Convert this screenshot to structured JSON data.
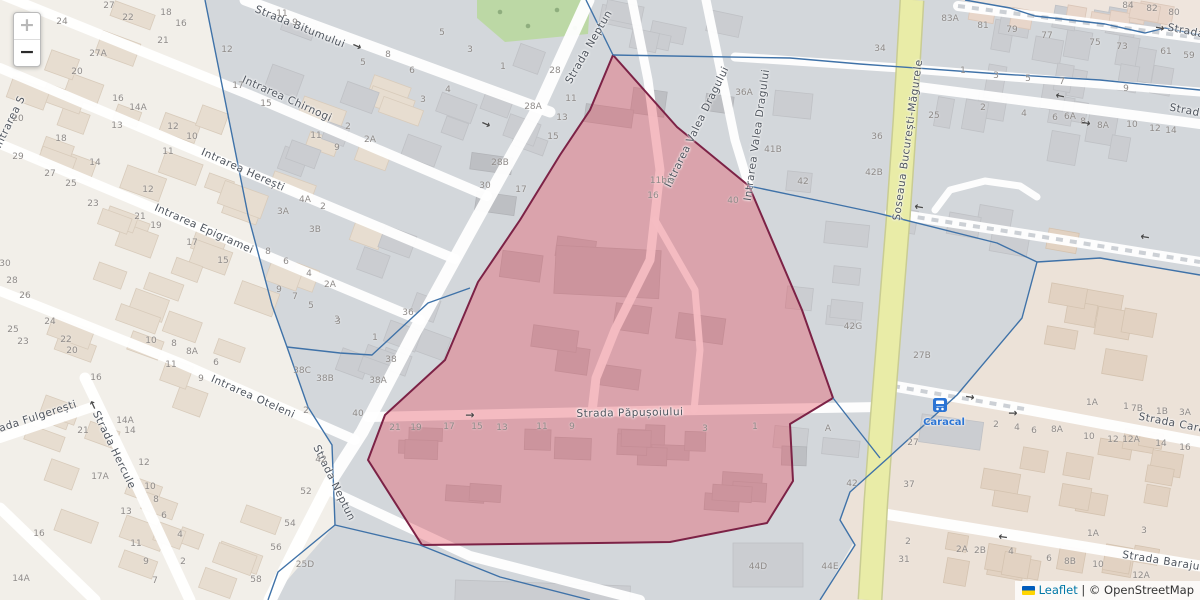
{
  "controls": {
    "zoom_in": "+",
    "zoom_out": "−"
  },
  "attribution": {
    "leaflet": "Leaflet",
    "separator": " | ",
    "osm": "© OpenStreetMap"
  },
  "colors": {
    "boundary_blue": "#3f72a8",
    "selection_fill": "#e4505f",
    "selection_stroke": "#7c2246",
    "highway_yellow": "#e9eca7",
    "park_green": "#bcd8a5",
    "transit_blue": "#2b74d4",
    "leaflet_link_blue": "#0078A8"
  },
  "pois": [
    {
      "label": "Caracal",
      "type": "bus-stop",
      "icon_x": 933,
      "icon_y": 398,
      "label_x": 944,
      "label_y": 417
    }
  ],
  "streets": [
    {
      "t": "Strada Bitumului",
      "x": 300,
      "y": 27,
      "r": 22
    },
    {
      "t": "Intrarea Chirnogi",
      "x": 287,
      "y": 99,
      "r": 24
    },
    {
      "t": "Intrarea Herești",
      "x": 243,
      "y": 170,
      "r": 24
    },
    {
      "t": "Intrarea Epigramei",
      "x": 204,
      "y": 229,
      "r": 24
    },
    {
      "t": "Intrarea Oteleni",
      "x": 253,
      "y": 397,
      "r": 24
    },
    {
      "t": "Strada Fulgerești",
      "x": 30,
      "y": 419,
      "r": -18
    },
    {
      "t": "Strada Hercule",
      "x": 114,
      "y": 450,
      "r": 64
    },
    {
      "t": "Strada Neptun",
      "x": 589,
      "y": 47,
      "r": -60
    },
    {
      "t": "Strada Neptun",
      "x": 334,
      "y": 483,
      "r": 64
    },
    {
      "t": "Intrarea Valea Dragului",
      "x": 697,
      "y": 127,
      "r": -64
    },
    {
      "t": "Intrarea Valea Dragului",
      "x": 757,
      "y": 135,
      "r": -82
    },
    {
      "t": "Șoseaua București-Măgurele",
      "x": 908,
      "y": 140,
      "r": -82
    },
    {
      "t": "Strada Păpușoiului",
      "x": 630,
      "y": 413,
      "r": -1
    },
    {
      "t": "Strada Cara",
      "x": 1172,
      "y": 423,
      "r": 11
    },
    {
      "t": "Strada Barajului",
      "x": 1168,
      "y": 562,
      "r": 9
    },
    {
      "t": "Strada",
      "x": 1186,
      "y": 31,
      "r": 11
    },
    {
      "t": "Strada",
      "x": 1188,
      "y": 111,
      "r": 11
    },
    {
      "t": "Intrarea S",
      "x": 10,
      "y": 122,
      "r": -64
    }
  ],
  "house_numbers": [
    {
      "t": "27",
      "x": 109,
      "y": 6
    },
    {
      "t": "22",
      "x": 128,
      "y": 18
    },
    {
      "t": "18",
      "x": 166,
      "y": 13
    },
    {
      "t": "16",
      "x": 181,
      "y": 24
    },
    {
      "t": "21",
      "x": 163,
      "y": 41
    },
    {
      "t": "12",
      "x": 227,
      "y": 50
    },
    {
      "t": "24",
      "x": 62,
      "y": 22
    },
    {
      "t": "27A",
      "x": 98,
      "y": 54
    },
    {
      "t": "20",
      "x": 77,
      "y": 72
    },
    {
      "t": "16",
      "x": 118,
      "y": 99
    },
    {
      "t": "14A",
      "x": 138,
      "y": 108
    },
    {
      "t": "13",
      "x": 117,
      "y": 126
    },
    {
      "t": "12",
      "x": 173,
      "y": 127
    },
    {
      "t": "10",
      "x": 192,
      "y": 137
    },
    {
      "t": "11",
      "x": 168,
      "y": 152
    },
    {
      "t": "17",
      "x": 238,
      "y": 86
    },
    {
      "t": "15",
      "x": 266,
      "y": 104
    },
    {
      "t": "20",
      "x": 18,
      "y": 119
    },
    {
      "t": "18",
      "x": 61,
      "y": 139
    },
    {
      "t": "29",
      "x": 18,
      "y": 157
    },
    {
      "t": "27",
      "x": 50,
      "y": 174
    },
    {
      "t": "25",
      "x": 71,
      "y": 184
    },
    {
      "t": "14",
      "x": 95,
      "y": 163
    },
    {
      "t": "12",
      "x": 148,
      "y": 190
    },
    {
      "t": "23",
      "x": 93,
      "y": 204
    },
    {
      "t": "21",
      "x": 140,
      "y": 217
    },
    {
      "t": "19",
      "x": 156,
      "y": 226
    },
    {
      "t": "17",
      "x": 192,
      "y": 243
    },
    {
      "t": "15",
      "x": 223,
      "y": 261
    },
    {
      "t": "30",
      "x": 5,
      "y": 264
    },
    {
      "t": "28",
      "x": 12,
      "y": 281
    },
    {
      "t": "26",
      "x": 25,
      "y": 296
    },
    {
      "t": "25",
      "x": 13,
      "y": 330
    },
    {
      "t": "23",
      "x": 23,
      "y": 342
    },
    {
      "t": "24",
      "x": 50,
      "y": 322
    },
    {
      "t": "22",
      "x": 66,
      "y": 340
    },
    {
      "t": "20",
      "x": 72,
      "y": 351
    },
    {
      "t": "16",
      "x": 96,
      "y": 378
    },
    {
      "t": "10",
      "x": 151,
      "y": 341
    },
    {
      "t": "8",
      "x": 174,
      "y": 344
    },
    {
      "t": "8A",
      "x": 192,
      "y": 352
    },
    {
      "t": "6",
      "x": 216,
      "y": 363
    },
    {
      "t": "11",
      "x": 171,
      "y": 365
    },
    {
      "t": "9",
      "x": 201,
      "y": 379
    },
    {
      "t": "21",
      "x": 83,
      "y": 431
    },
    {
      "t": "14A",
      "x": 125,
      "y": 421
    },
    {
      "t": "14",
      "x": 130,
      "y": 431
    },
    {
      "t": "12",
      "x": 144,
      "y": 463
    },
    {
      "t": "10",
      "x": 150,
      "y": 487
    },
    {
      "t": "8",
      "x": 156,
      "y": 500
    },
    {
      "t": "6",
      "x": 164,
      "y": 516
    },
    {
      "t": "4",
      "x": 180,
      "y": 535
    },
    {
      "t": "2",
      "x": 183,
      "y": 562
    },
    {
      "t": "17A",
      "x": 100,
      "y": 477
    },
    {
      "t": "13",
      "x": 126,
      "y": 512
    },
    {
      "t": "11",
      "x": 136,
      "y": 544
    },
    {
      "t": "9",
      "x": 146,
      "y": 562
    },
    {
      "t": "7",
      "x": 155,
      "y": 581
    },
    {
      "t": "16",
      "x": 39,
      "y": 534
    },
    {
      "t": "14A",
      "x": 21,
      "y": 579
    },
    {
      "t": "11",
      "x": 282,
      "y": 14
    },
    {
      "t": "9",
      "x": 295,
      "y": 23
    },
    {
      "t": "8",
      "x": 388,
      "y": 55
    },
    {
      "t": "5",
      "x": 363,
      "y": 63
    },
    {
      "t": "6",
      "x": 412,
      "y": 71
    },
    {
      "t": "5",
      "x": 442,
      "y": 33
    },
    {
      "t": "3",
      "x": 470,
      "y": 50
    },
    {
      "t": "4",
      "x": 448,
      "y": 90
    },
    {
      "t": "3",
      "x": 423,
      "y": 100
    },
    {
      "t": "1",
      "x": 503,
      "y": 67
    },
    {
      "t": "28",
      "x": 555,
      "y": 71
    },
    {
      "t": "28A",
      "x": 533,
      "y": 107
    },
    {
      "t": "28B",
      "x": 500,
      "y": 163
    },
    {
      "t": "30",
      "x": 485,
      "y": 186
    },
    {
      "t": "11",
      "x": 571,
      "y": 99
    },
    {
      "t": "13",
      "x": 562,
      "y": 118
    },
    {
      "t": "15",
      "x": 553,
      "y": 137
    },
    {
      "t": "17",
      "x": 521,
      "y": 190
    },
    {
      "t": "2A",
      "x": 370,
      "y": 140
    },
    {
      "t": "2",
      "x": 348,
      "y": 127
    },
    {
      "t": "11",
      "x": 316,
      "y": 136
    },
    {
      "t": "9",
      "x": 337,
      "y": 148
    },
    {
      "t": "4A",
      "x": 305,
      "y": 200
    },
    {
      "t": "2",
      "x": 323,
      "y": 207
    },
    {
      "t": "3A",
      "x": 283,
      "y": 212
    },
    {
      "t": "3B",
      "x": 315,
      "y": 230
    },
    {
      "t": "8",
      "x": 268,
      "y": 252
    },
    {
      "t": "6",
      "x": 286,
      "y": 262
    },
    {
      "t": "4",
      "x": 309,
      "y": 274
    },
    {
      "t": "2A",
      "x": 330,
      "y": 285
    },
    {
      "t": "9",
      "x": 279,
      "y": 290
    },
    {
      "t": "7",
      "x": 295,
      "y": 297
    },
    {
      "t": "5",
      "x": 311,
      "y": 306
    },
    {
      "t": "3",
      "x": 337,
      "y": 320
    },
    {
      "t": "36",
      "x": 408,
      "y": 313
    },
    {
      "t": "3",
      "x": 338,
      "y": 322
    },
    {
      "t": "1",
      "x": 375,
      "y": 338
    },
    {
      "t": "38",
      "x": 391,
      "y": 360
    },
    {
      "t": "38C",
      "x": 302,
      "y": 371
    },
    {
      "t": "38B",
      "x": 325,
      "y": 379
    },
    {
      "t": "38A",
      "x": 378,
      "y": 381
    },
    {
      "t": "40",
      "x": 358,
      "y": 414
    },
    {
      "t": "2",
      "x": 306,
      "y": 411
    },
    {
      "t": "11bis",
      "x": 662,
      "y": 181
    },
    {
      "t": "16",
      "x": 653,
      "y": 196
    },
    {
      "t": "40",
      "x": 733,
      "y": 201
    },
    {
      "t": "36A",
      "x": 744,
      "y": 93
    },
    {
      "t": "41B",
      "x": 773,
      "y": 150
    },
    {
      "t": "42",
      "x": 803,
      "y": 182
    },
    {
      "t": "21",
      "x": 395,
      "y": 428
    },
    {
      "t": "19",
      "x": 416,
      "y": 428
    },
    {
      "t": "17",
      "x": 449,
      "y": 427
    },
    {
      "t": "15",
      "x": 477,
      "y": 427
    },
    {
      "t": "13",
      "x": 502,
      "y": 428
    },
    {
      "t": "11",
      "x": 542,
      "y": 427
    },
    {
      "t": "9",
      "x": 572,
      "y": 427
    },
    {
      "t": "3",
      "x": 705,
      "y": 429
    },
    {
      "t": "1",
      "x": 755,
      "y": 427
    },
    {
      "t": "A",
      "x": 828,
      "y": 429
    },
    {
      "t": "42G",
      "x": 853,
      "y": 327
    },
    {
      "t": "27B",
      "x": 922,
      "y": 356
    },
    {
      "t": "42",
      "x": 852,
      "y": 484
    },
    {
      "t": "37",
      "x": 909,
      "y": 485
    },
    {
      "t": "27",
      "x": 913,
      "y": 443
    },
    {
      "t": "25D",
      "x": 305,
      "y": 565
    },
    {
      "t": "52",
      "x": 306,
      "y": 492
    },
    {
      "t": "54",
      "x": 290,
      "y": 524
    },
    {
      "t": "56",
      "x": 276,
      "y": 548
    },
    {
      "t": "58",
      "x": 256,
      "y": 580
    },
    {
      "t": "42",
      "x": 321,
      "y": 460
    },
    {
      "t": "83A",
      "x": 950,
      "y": 19
    },
    {
      "t": "81",
      "x": 983,
      "y": 26
    },
    {
      "t": "79",
      "x": 1012,
      "y": 30
    },
    {
      "t": "77",
      "x": 1047,
      "y": 36
    },
    {
      "t": "75",
      "x": 1095,
      "y": 43
    },
    {
      "t": "73",
      "x": 1122,
      "y": 47
    },
    {
      "t": "61",
      "x": 1166,
      "y": 52
    },
    {
      "t": "59",
      "x": 1189,
      "y": 56
    },
    {
      "t": "84",
      "x": 1128,
      "y": 6
    },
    {
      "t": "82",
      "x": 1152,
      "y": 9
    },
    {
      "t": "80",
      "x": 1174,
      "y": 13
    },
    {
      "t": "34",
      "x": 880,
      "y": 49
    },
    {
      "t": "1",
      "x": 963,
      "y": 71
    },
    {
      "t": "3",
      "x": 996,
      "y": 76
    },
    {
      "t": "5",
      "x": 1028,
      "y": 79
    },
    {
      "t": "7",
      "x": 1062,
      "y": 82
    },
    {
      "t": "9",
      "x": 1126,
      "y": 89
    },
    {
      "t": "25",
      "x": 934,
      "y": 116
    },
    {
      "t": "2",
      "x": 983,
      "y": 108
    },
    {
      "t": "4",
      "x": 1024,
      "y": 114
    },
    {
      "t": "6",
      "x": 1055,
      "y": 118
    },
    {
      "t": "6A",
      "x": 1070,
      "y": 117
    },
    {
      "t": "8",
      "x": 1083,
      "y": 122
    },
    {
      "t": "8A",
      "x": 1103,
      "y": 126
    },
    {
      "t": "10",
      "x": 1132,
      "y": 125
    },
    {
      "t": "12",
      "x": 1155,
      "y": 129
    },
    {
      "t": "14",
      "x": 1171,
      "y": 131
    },
    {
      "t": "36",
      "x": 877,
      "y": 137
    },
    {
      "t": "42B",
      "x": 874,
      "y": 173
    },
    {
      "t": "1A",
      "x": 1092,
      "y": 403
    },
    {
      "t": "1",
      "x": 1126,
      "y": 407
    },
    {
      "t": "7B",
      "x": 1137,
      "y": 409
    },
    {
      "t": "1B",
      "x": 1162,
      "y": 412
    },
    {
      "t": "3A",
      "x": 1185,
      "y": 413
    },
    {
      "t": "2",
      "x": 996,
      "y": 425
    },
    {
      "t": "4",
      "x": 1017,
      "y": 428
    },
    {
      "t": "6",
      "x": 1034,
      "y": 431
    },
    {
      "t": "8A",
      "x": 1057,
      "y": 430
    },
    {
      "t": "10",
      "x": 1089,
      "y": 437
    },
    {
      "t": "12",
      "x": 1113,
      "y": 440
    },
    {
      "t": "12A",
      "x": 1131,
      "y": 440
    },
    {
      "t": "14",
      "x": 1161,
      "y": 444
    },
    {
      "t": "16",
      "x": 1185,
      "y": 448
    },
    {
      "t": "1A",
      "x": 1093,
      "y": 534
    },
    {
      "t": "3",
      "x": 1144,
      "y": 531
    },
    {
      "t": "2A",
      "x": 962,
      "y": 550
    },
    {
      "t": "2B",
      "x": 980,
      "y": 551
    },
    {
      "t": "4",
      "x": 1011,
      "y": 552
    },
    {
      "t": "6",
      "x": 1049,
      "y": 559
    },
    {
      "t": "8B",
      "x": 1070,
      "y": 562
    },
    {
      "t": "10",
      "x": 1098,
      "y": 565
    },
    {
      "t": "12A",
      "x": 1141,
      "y": 576
    },
    {
      "t": "2",
      "x": 908,
      "y": 542
    },
    {
      "t": "31",
      "x": 904,
      "y": 560
    },
    {
      "t": "44D",
      "x": 758,
      "y": 567
    },
    {
      "t": "44E",
      "x": 830,
      "y": 567
    }
  ],
  "oneway_arrows": [
    {
      "x": 357,
      "y": 46,
      "r": 24
    },
    {
      "x": 486,
      "y": 124,
      "r": 24
    },
    {
      "x": 470,
      "y": 415,
      "r": 0
    },
    {
      "x": 1013,
      "y": 413,
      "r": 0
    },
    {
      "x": 1060,
      "y": 96,
      "r": 192
    },
    {
      "x": 970,
      "y": 397,
      "r": 10
    },
    {
      "x": 1003,
      "y": 537,
      "r": 188
    },
    {
      "x": 919,
      "y": 207,
      "r": 190
    },
    {
      "x": 1145,
      "y": 237,
      "r": 190
    },
    {
      "x": 1160,
      "y": 28,
      "r": 11
    },
    {
      "x": 1086,
      "y": 123,
      "r": 10
    },
    {
      "x": 93,
      "y": 405,
      "r": -115
    }
  ]
}
